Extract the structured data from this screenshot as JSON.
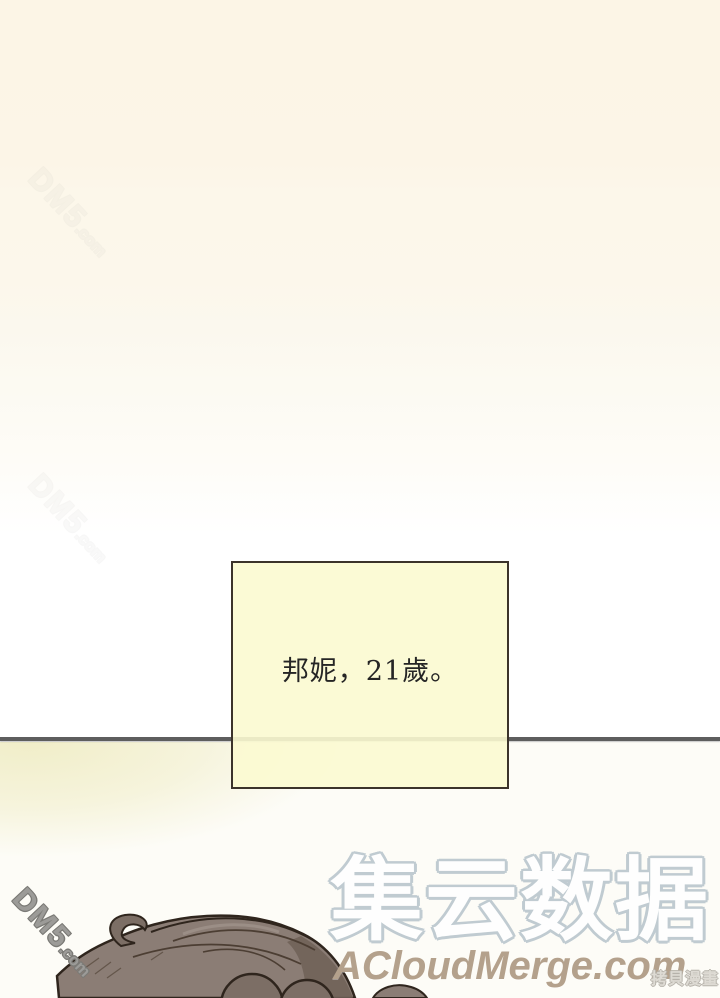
{
  "page": {
    "kind": "manhwa-page-scan",
    "colors": {
      "bg_cream": "#fcf5e6",
      "bg_white": "#ffffff",
      "below_line_wash": "#f0edc6",
      "divider": "#5e5e5e"
    }
  },
  "caption_box": {
    "text": "邦妮，21歲。",
    "fill": "#fbf9d0",
    "border": "#3b332b",
    "text_color": "#252525"
  },
  "watermarks": {
    "dm5": {
      "main": "DM5",
      "suffix": ".com",
      "outline": "#7b7a76"
    },
    "brand_cn": {
      "text": "集云数据",
      "outline": "#c0cbd1",
      "fill": "#fefefe"
    },
    "brand_en": {
      "text": "ACloudMerge.com",
      "color": "#b4a18c"
    },
    "corner": {
      "text": "拷貝漫畫",
      "color": "#cdcac4"
    }
  },
  "artwork": {
    "subject": "character-hair-top",
    "colors": {
      "base": "#8b7d75",
      "shade": "#6f6057",
      "curl": "#7c6e65",
      "line": "#2f251d",
      "strand": "#4c3e33",
      "highlight": "#a79a91"
    }
  }
}
